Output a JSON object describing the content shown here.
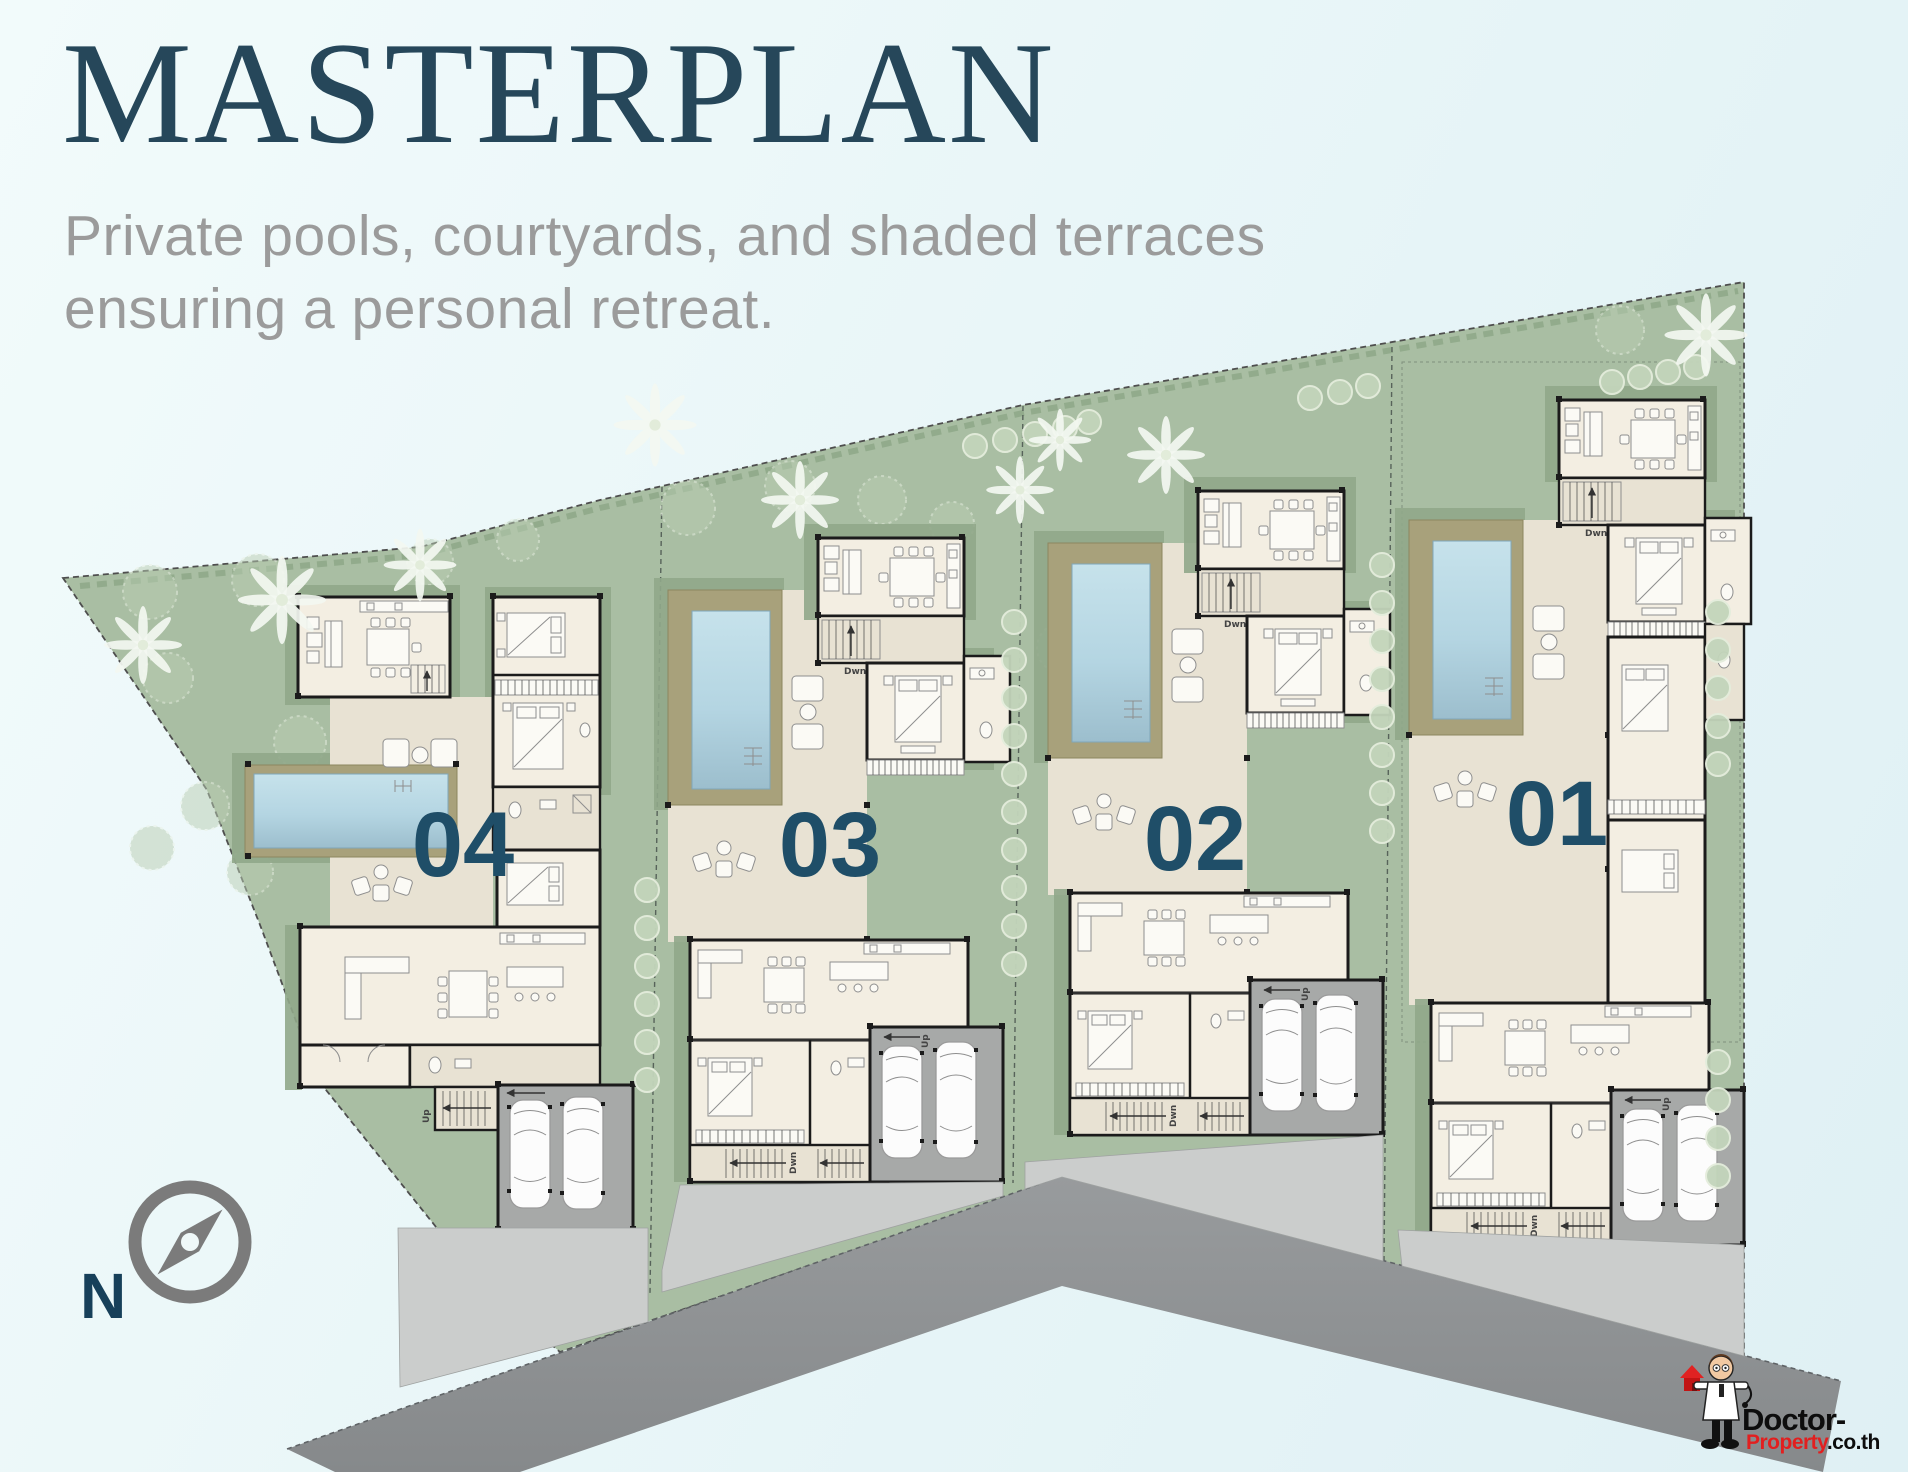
{
  "header": {
    "title": "MASTERPLAN",
    "subtitle_line1": "Private pools, courtyards, and shaded terraces",
    "subtitle_line2": "ensuring a personal retreat."
  },
  "villas": [
    {
      "id": "villa-04",
      "label": "04"
    },
    {
      "id": "villa-03",
      "label": "03"
    },
    {
      "id": "villa-02",
      "label": "02"
    },
    {
      "id": "villa-01",
      "label": "01"
    }
  ],
  "compass": {
    "north_label": "N"
  },
  "plan_labels": {
    "stairs_up": "Up",
    "stairs_down": "Dwn"
  },
  "watermark": {
    "brand_part1": "Doctor-",
    "brand_part2": "Property",
    "brand_part3": ".co.th"
  },
  "colors": {
    "title_ink": "#26475A",
    "accent_teal": "#1F4E68",
    "subtitle_gray": "#9B9B9B",
    "site_green": "#A9BEA3",
    "site_green_shadow": "#90A78A",
    "pool_blue": "#BBDAE6",
    "pool_deck_tan": "#A8A17B",
    "floor_cream": "#F3EEE2",
    "terrace_beige": "#E8E2D3",
    "wall_black": "#1B1B1B",
    "garage_gray": "#A7A9A8",
    "apron_gray": "#CBCDCC",
    "road_gray": "#8F9294",
    "logo_red": "#E21F1F"
  }
}
